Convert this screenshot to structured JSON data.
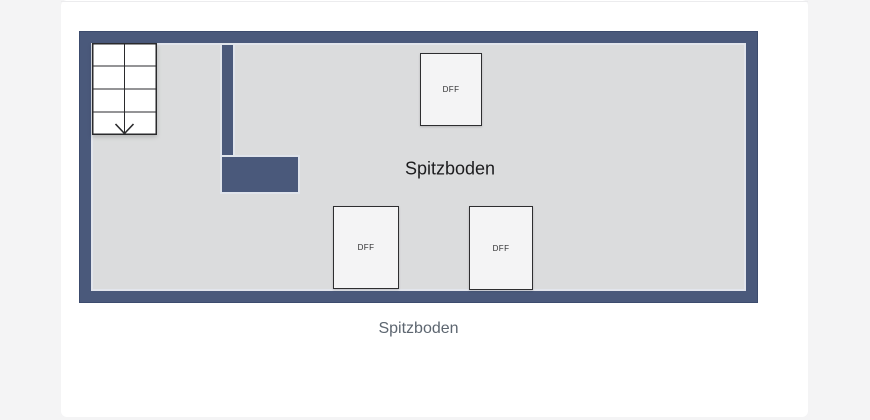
{
  "floorplan": {
    "title": "Spitzboden",
    "caption": "Spitzboden",
    "roof_windows": [
      {
        "label": "DFF",
        "position": "top"
      },
      {
        "label": "DFF",
        "position": "bottom-left"
      },
      {
        "label": "DFF",
        "position": "bottom-right"
      }
    ],
    "stairs": {
      "direction": "down",
      "columns": 2,
      "rows": 4
    },
    "colors": {
      "wall": "#4a597b",
      "wallOutline": "#3c4b6d",
      "floor": "#dbdcdd",
      "card": "#ffffff",
      "bg": "#f4f4f5",
      "captionText": "#5d6670",
      "labelText": "#1c1c1e"
    }
  }
}
